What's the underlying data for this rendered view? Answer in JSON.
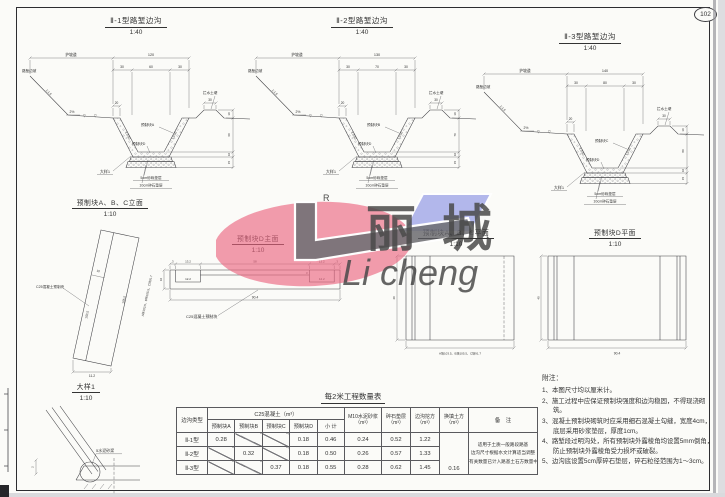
{
  "page": {
    "number": "102"
  },
  "sections": [
    {
      "title": "Ⅱ-1型路堑边沟",
      "scale": "1:40",
      "berm": "护坡道",
      "total": "120",
      "d1": "30",
      "d2": "60",
      "d3": "30",
      "top20": "20",
      "mound_w": "30",
      "mound_label": "拦水土埂",
      "slope_label": "路堑边坡",
      "cut_slope": "1:1.5",
      "grade": "2%",
      "islope": "1:0.50",
      "v_top": "10",
      "v_depth": "60",
      "v_block": "10",
      "v_cushion": "15",
      "block_side": "预制块A",
      "block_bottom": "预制块D",
      "cushion1": "5cm砂砾垫层",
      "cushion2": "10cm碎石垫层",
      "detail_ref": "大样1",
      "water_symbol": "▽"
    },
    {
      "title": "Ⅱ-2型路堑边沟",
      "scale": "1:40",
      "berm": "护坡道",
      "total": "130",
      "d1": "30",
      "d2": "70",
      "d3": "30",
      "top20": "20",
      "mound_w": "30",
      "mound_label": "拦水土埂",
      "slope_label": "路堑边坡",
      "cut_slope": "1:1.5",
      "grade": "2%",
      "islope": "1:0.50",
      "v_top": "10",
      "v_depth": "70",
      "v_block": "10",
      "v_cushion": "15",
      "block_side": "预制块B",
      "block_bottom": "预制块D",
      "cushion1": "5cm砂砾垫层",
      "cushion2": "10cm碎石垫层",
      "detail_ref": "大样1",
      "water_symbol": "▽"
    },
    {
      "title": "Ⅱ-3型路堑边沟",
      "scale": "1:40",
      "berm": "护坡道",
      "total": "140",
      "d1": "30",
      "d2": "80",
      "d3": "30",
      "top20": "20",
      "mound_w": "30",
      "mound_label": "拦水土埂",
      "slope_label": "路堑边坡",
      "cut_slope": "1:1.5",
      "grade": "2%",
      "islope": "1:0.50",
      "v_top": "10",
      "v_depth": "80",
      "v_block": "10",
      "v_cushion": "15",
      "block_side": "预制块C",
      "block_bottom": "预制块D",
      "cushion1": "5cm砂砾垫层",
      "cushion2": "10cm碎石垫层",
      "detail_ref": "大样1",
      "water_symbol": "▽"
    }
  ],
  "blocks": {
    "abc_elev": {
      "title": "预制块A、B、C立面",
      "scale": "1:10",
      "material": "C25混凝土预制块",
      "w": "10",
      "len_a": "103.5",
      "len_b": "105.5",
      "bottom": "11.2",
      "note": "A块103.5、B块105.5、C块91.7"
    },
    "d_front": {
      "title": "预制块D主面",
      "scale": "1:10",
      "material": "C25混凝土预制块",
      "t1": "3",
      "t2": "13.2",
      "t3": "58",
      "t4": "13.2",
      "t5": "3",
      "n1": "12.2",
      "n2": "12.2",
      "notch": "3",
      "h": "10",
      "w": "90.4"
    },
    "abc_plan": {
      "title": "预制块A、B、C平面",
      "scale": "1:10",
      "h": "40",
      "w_note": "A块103.5、B块105.5、C块91.7"
    },
    "d_plan": {
      "title": "预制块D平面",
      "scale": "1:10",
      "h": "40",
      "w": "90.4"
    }
  },
  "detail": {
    "title": "大样1",
    "scale": "1:10",
    "label": "5水泥砂浆",
    "dim": "2"
  },
  "table": {
    "title": "每2米工程数量表",
    "h_type": "边沟类型",
    "h_c25": "C25混凝土（m³）",
    "h_sub": [
      "预制块A",
      "预制块B",
      "预制块C",
      "预制块D",
      "小 计"
    ],
    "h_mortar_1": "M10水泥砂浆",
    "h_mortar_2": "（m³）",
    "h_gravel_1": "碎石垫层",
    "h_gravel_2": "（m³）",
    "h_exc_1": "边沟挖方",
    "h_exc_2": "（m³）",
    "h_repl_1": "换填土方",
    "h_repl_2": "（m³）",
    "h_remark": "备　注",
    "rows": [
      {
        "type": "Ⅱ-1型",
        "a": "0.28",
        "b": "",
        "c": "",
        "d": "0.18",
        "sum": "0.46",
        "mortar": "0.24",
        "gravel": "0.52",
        "exc": "1.22"
      },
      {
        "type": "Ⅱ-2型",
        "a": "",
        "b": "0.32",
        "c": "",
        "d": "0.18",
        "sum": "0.50",
        "mortar": "0.26",
        "gravel": "0.57",
        "exc": "1.33"
      },
      {
        "type": "Ⅱ-3型",
        "a": "",
        "b": "",
        "c": "0.37",
        "d": "0.18",
        "sum": "0.55",
        "mortar": "0.28",
        "gravel": "0.62",
        "exc": "1.45"
      }
    ],
    "repl_value": "0.16",
    "remark_lines": [
      "适用于土质一般路段路基",
      "边沟尺寸根据水文计算适当调整",
      "有关数量已计入路基土石方数量中"
    ]
  },
  "notes": {
    "title": "附注：",
    "items": [
      "1、本图尺寸均以厘米计。",
      "2、施工过程中应保证预制块强度和边沟稳固，不得现浇砌筑。",
      "3、混凝土预制块砌筑时应采用细石混凝土勾缝，宽度4cm，底层采用砂浆垫层，厚度1cm。",
      "4、路堑段过明沟处，所有预制块外露棱角均设置5mm倒角，防止预制块外露棱角受力损坏或破裂。",
      "5、边沟底设置5cm厚碎石垫层，碎石粒径范围为1～3cm。"
    ]
  },
  "watermark": {
    "cn": "丽 城",
    "en": "Li cheng",
    "r": "R"
  }
}
